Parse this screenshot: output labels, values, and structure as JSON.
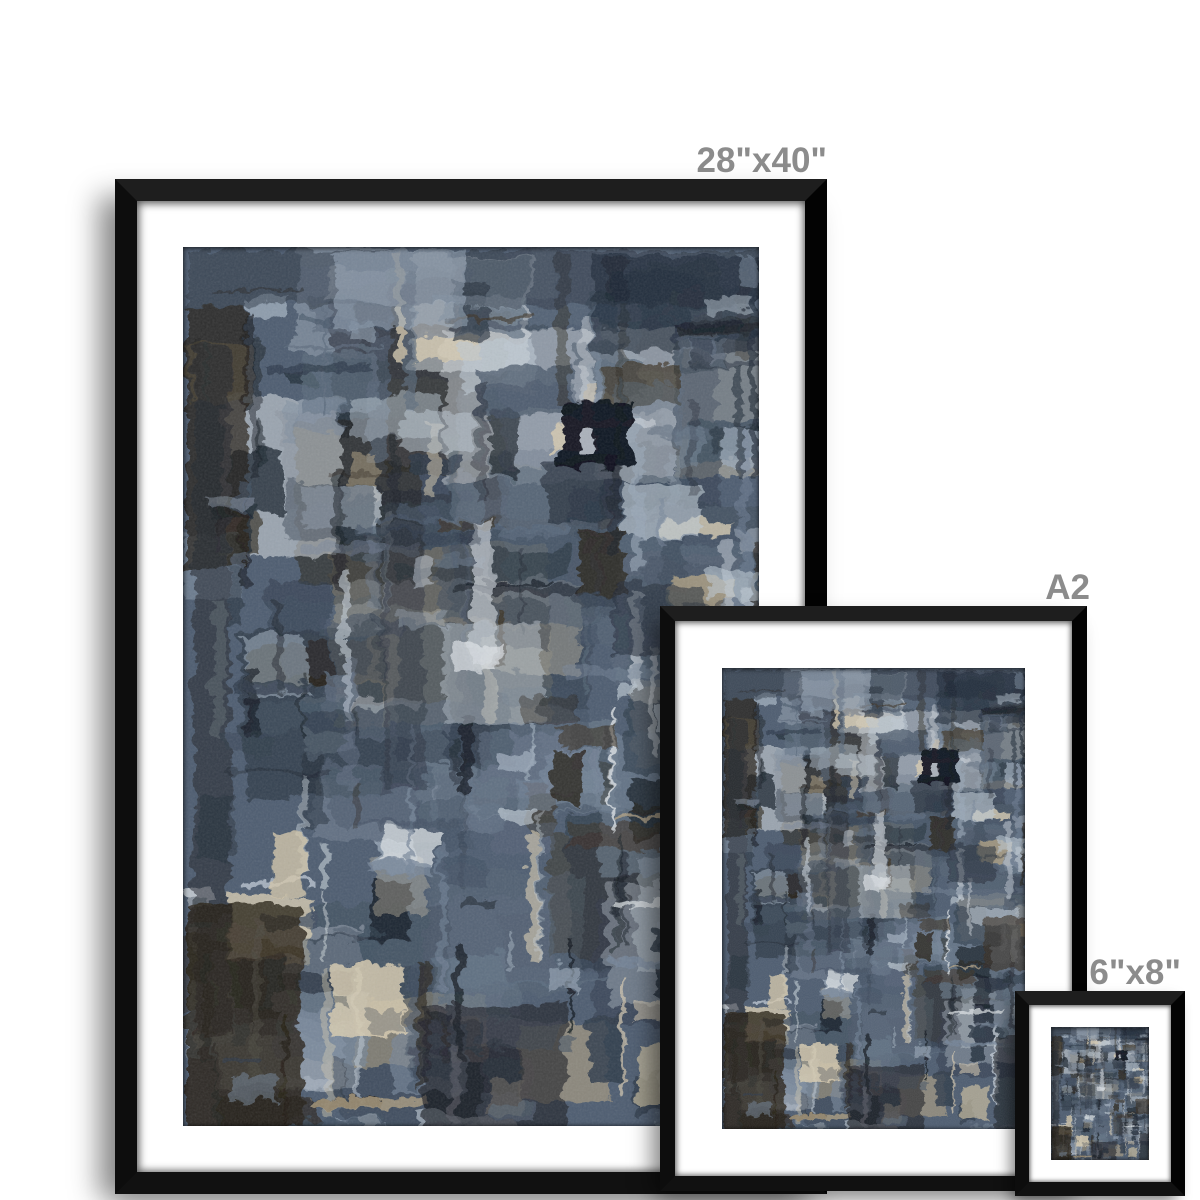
{
  "page": {
    "background_color": "#ffffff"
  },
  "labels": {
    "color": "#8c8c8c"
  },
  "prints": [
    {
      "id": "28x40",
      "size_label": "28\"x40\""
    },
    {
      "id": "a2",
      "size_label": "A2"
    },
    {
      "id": "6x8",
      "size_label": "6\"x8\""
    }
  ],
  "frame": {
    "border_color": "#0d0d0d",
    "mat_color": "#ffffff"
  },
  "artwork": {
    "viewbox": [
      580,
      868
    ],
    "base_color": "#4d5c6f",
    "seed": 20,
    "counts": {
      "patches": 48,
      "blocks": 150,
      "v_streaks": 90,
      "h_streaks": 50,
      "top_strokes": 40
    },
    "palette": [
      {
        "color": "#10161f",
        "w": 3
      },
      {
        "color": "#1d2734",
        "w": 3
      },
      {
        "color": "#2e3a49",
        "w": 4
      },
      {
        "color": "#415062",
        "w": 5
      },
      {
        "color": "#5c6b7d",
        "w": 5
      },
      {
        "color": "#76869a",
        "w": 4
      },
      {
        "color": "#9aa8b8",
        "w": 3
      },
      {
        "color": "#bec9d4",
        "w": 3
      },
      {
        "color": "#dfe4e8",
        "w": 1.5
      },
      {
        "color": "#d6cbb2",
        "w": 1.5
      },
      {
        "color": "#b1a284",
        "w": 1
      },
      {
        "color": "#3a3022",
        "w": 1.5
      },
      {
        "color": "#241d13",
        "w": 2
      }
    ],
    "streak_lights": [
      "#c7d0d9",
      "#dfe4e8",
      "#d6cbb2"
    ],
    "streak_darks": [
      "#12181f",
      "#1c222b",
      "#241d13"
    ],
    "features": [
      {
        "x": 0,
        "y": 0,
        "w": 580,
        "h": 55,
        "color": "#2b3644",
        "o": 0.5,
        "r": 0
      },
      {
        "x": 0,
        "y": 55,
        "w": 60,
        "h": 260,
        "color": "#221c14",
        "o": 0.7,
        "r": 0
      },
      {
        "x": 150,
        "y": 0,
        "w": 130,
        "h": 75,
        "color": "#9fb0c2",
        "o": 0.5,
        "r": -2
      },
      {
        "x": 410,
        "y": 5,
        "w": 170,
        "h": 95,
        "color": "#1d2633",
        "o": 0.6,
        "r": 0
      },
      {
        "x": 8,
        "y": 95,
        "w": 36,
        "h": 680,
        "color": "#20242b",
        "o": 0.55,
        "r": 0
      },
      {
        "x": 218,
        "y": 158,
        "w": 72,
        "h": 40,
        "color": "#b9c4d0",
        "o": 0.55,
        "r": 3
      },
      {
        "x": 378,
        "y": 148,
        "w": 73,
        "h": 67,
        "color": "#0a0f19",
        "o": 0.95,
        "r": 0
      },
      {
        "x": 396,
        "y": 176,
        "w": 16,
        "h": 28,
        "color": "#c5ccd6",
        "o": 0.85,
        "r": 0
      },
      {
        "x": 198,
        "y": 250,
        "w": 42,
        "h": 280,
        "color": "#2a3240",
        "o": 0.5,
        "r": 0
      },
      {
        "x": 288,
        "y": 268,
        "w": 22,
        "h": 140,
        "color": "#ccd3da",
        "o": 0.65,
        "r": 0
      },
      {
        "x": 430,
        "y": 330,
        "w": 90,
        "h": 70,
        "color": "#222b38",
        "o": 0.55,
        "r": 2
      },
      {
        "x": 258,
        "y": 368,
        "w": 100,
        "h": 100,
        "color": "#b8c2cc",
        "o": 0.5,
        "r": -2
      },
      {
        "x": 498,
        "y": 465,
        "w": 82,
        "h": 100,
        "color": "#332a1e",
        "o": 0.6,
        "r": 0
      },
      {
        "x": 88,
        "y": 575,
        "w": 32,
        "h": 62,
        "color": "#d3c7ab",
        "o": 0.8,
        "r": 0
      },
      {
        "x": 0,
        "y": 645,
        "w": 118,
        "h": 223,
        "color": "#241d13",
        "o": 0.78,
        "r": 0
      },
      {
        "x": 520,
        "y": 690,
        "w": 60,
        "h": 178,
        "color": "#1a1e25",
        "o": 0.6,
        "r": 0
      },
      {
        "x": 148,
        "y": 705,
        "w": 72,
        "h": 72,
        "color": "#d8cdb2",
        "o": 0.85,
        "r": -2
      },
      {
        "x": 238,
        "y": 745,
        "w": 145,
        "h": 123,
        "color": "#1e2128",
        "o": 0.65,
        "r": 0
      },
      {
        "x": 455,
        "y": 785,
        "w": 52,
        "h": 62,
        "color": "#c9bda0",
        "o": 0.7,
        "r": 2
      }
    ]
  }
}
